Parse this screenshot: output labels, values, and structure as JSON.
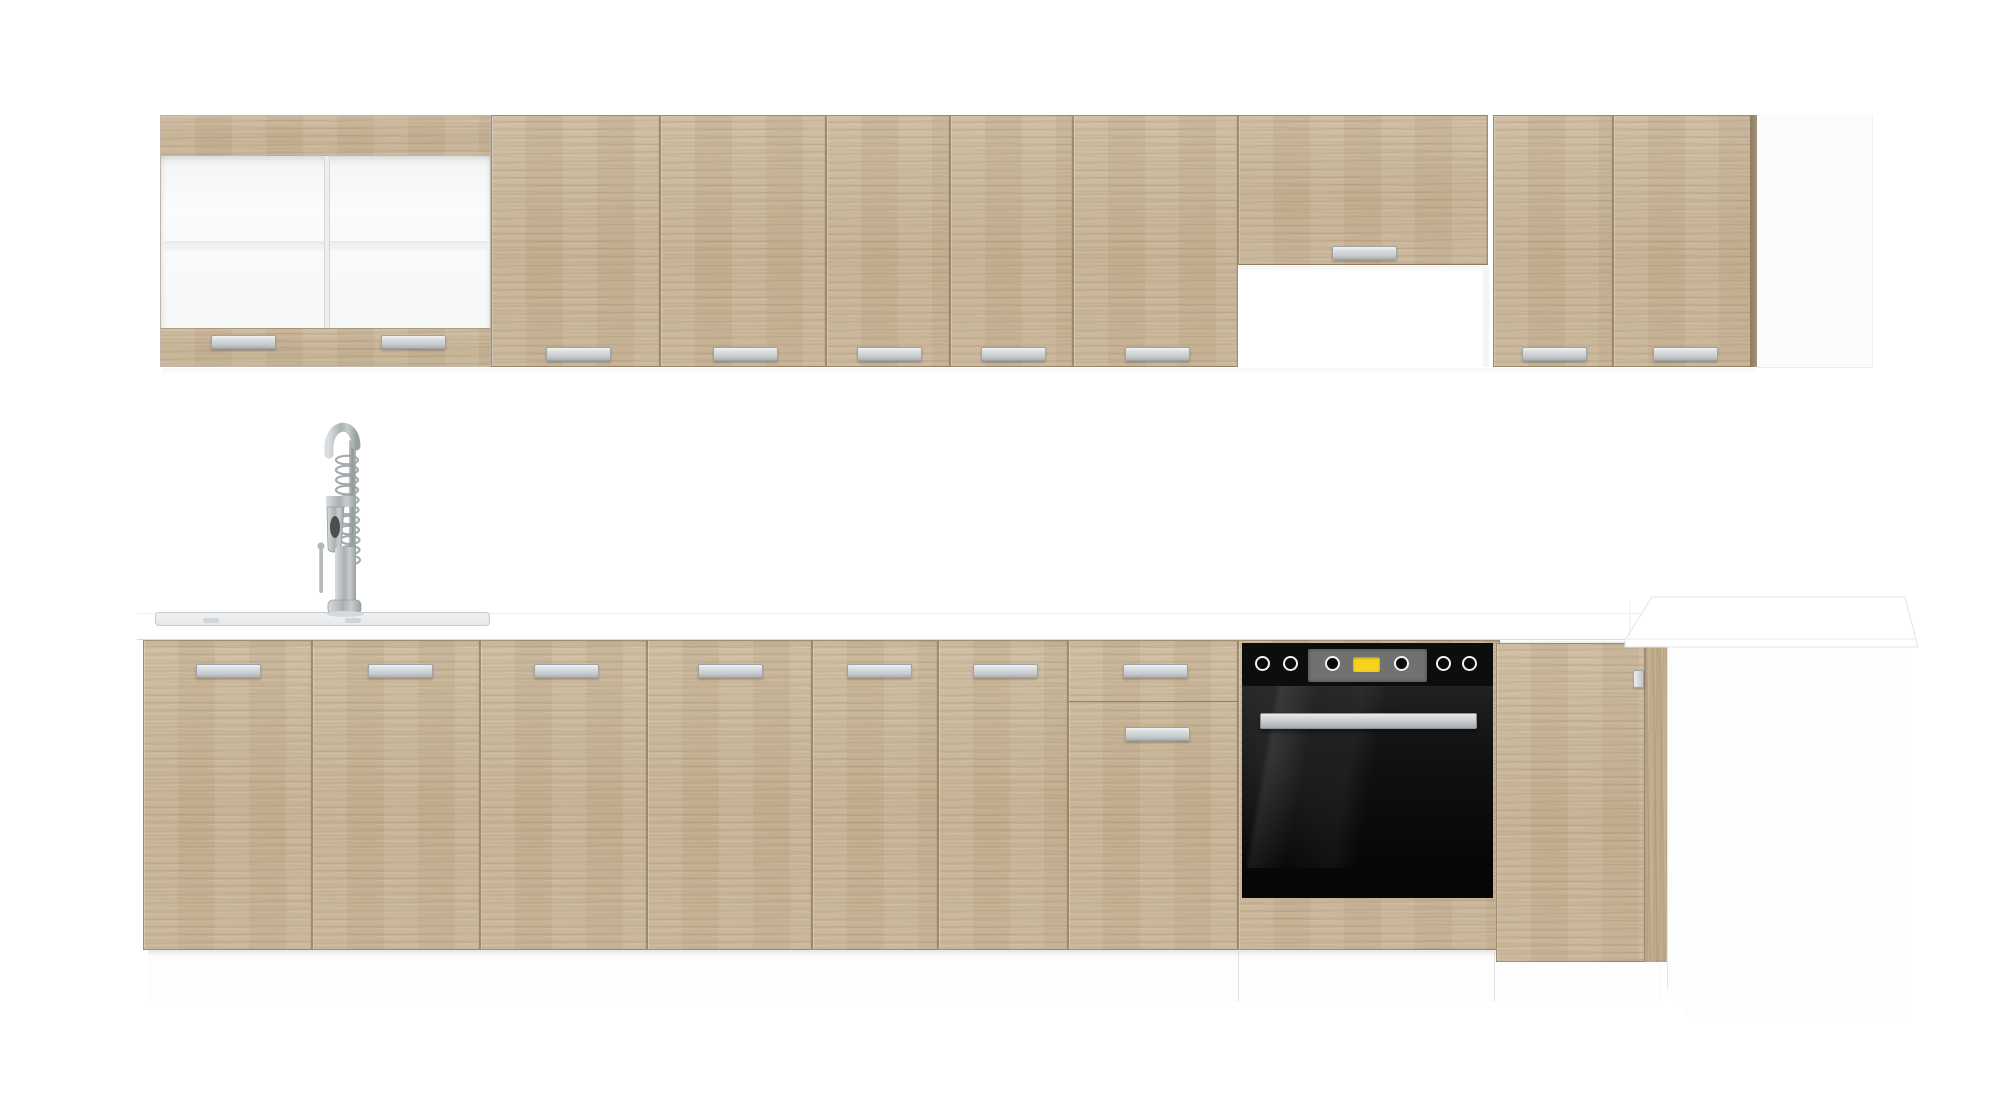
{
  "scene": {
    "description": "Product photo of a straight-run kitchen furniture set in light sonoma oak with white worktop: glass display wall unit, wall cabinets with recess for cooker hood, base cabinets with inset sink and spring mixer tap, built-in black oven and a white corner end section",
    "background": "#ffffff"
  },
  "palette": {
    "oak": "#c8b497",
    "oak_seam": "#746043",
    "handle_metal": "#d5d8da",
    "worktop_white": "#ffffff",
    "plinth_white": "#fdfdfd",
    "glass_interior": "#f7f8f8",
    "oven_black": "#0d0d0d",
    "oven_panel_gray": "#717171",
    "oven_display_yellow": "#f5d31d",
    "tap_steel": "#b9bcbe"
  },
  "wall_row": {
    "units": [
      {
        "name": "glass-display-cabinet",
        "doors": 2,
        "handles": 2,
        "front": "frosted glass with white interior and middle shelf"
      },
      {
        "name": "wall-cabinet-a",
        "doors": 2,
        "handles": 2
      },
      {
        "name": "wall-cabinet-b",
        "doors": 2,
        "handles": 2
      },
      {
        "name": "wall-cabinet-c",
        "doors": 1,
        "handles": 1
      },
      {
        "name": "hood-cabinet",
        "doors": 1,
        "handles": 1,
        "recess_below": true
      },
      {
        "name": "wall-cabinet-d",
        "doors": 2,
        "handles": 2
      },
      {
        "name": "white-end-panel",
        "doors": 0,
        "handles": 0
      }
    ],
    "total_handles": 10
  },
  "base_row": {
    "units": [
      {
        "name": "sink-base",
        "doors": 2,
        "handles": 2
      },
      {
        "name": "base-cabinet-a",
        "doors": 2,
        "handles": 2
      },
      {
        "name": "base-cabinet-b",
        "doors": 2,
        "handles": 2
      },
      {
        "name": "drawer-base",
        "drawers": 1,
        "doors": 1,
        "handles": 2
      },
      {
        "name": "oven-housing",
        "appliance": "built-in oven"
      },
      {
        "name": "corner-base",
        "doors": 1,
        "handles": 1
      },
      {
        "name": "white-corner-end-panel",
        "panels": 1
      }
    ]
  },
  "appliances": {
    "oven": {
      "color": "black",
      "knobs": 6,
      "display": "yellow LED window in gray inset panel",
      "handle": "steel bar",
      "door": "dark reflective glass"
    },
    "tap": {
      "style": "tall spring pull-down mixer",
      "finish": "brushed steel",
      "lever": "single side lever"
    },
    "sink": {
      "type": "flush inset",
      "finish": "stainless",
      "position": "left section of worktop"
    }
  }
}
